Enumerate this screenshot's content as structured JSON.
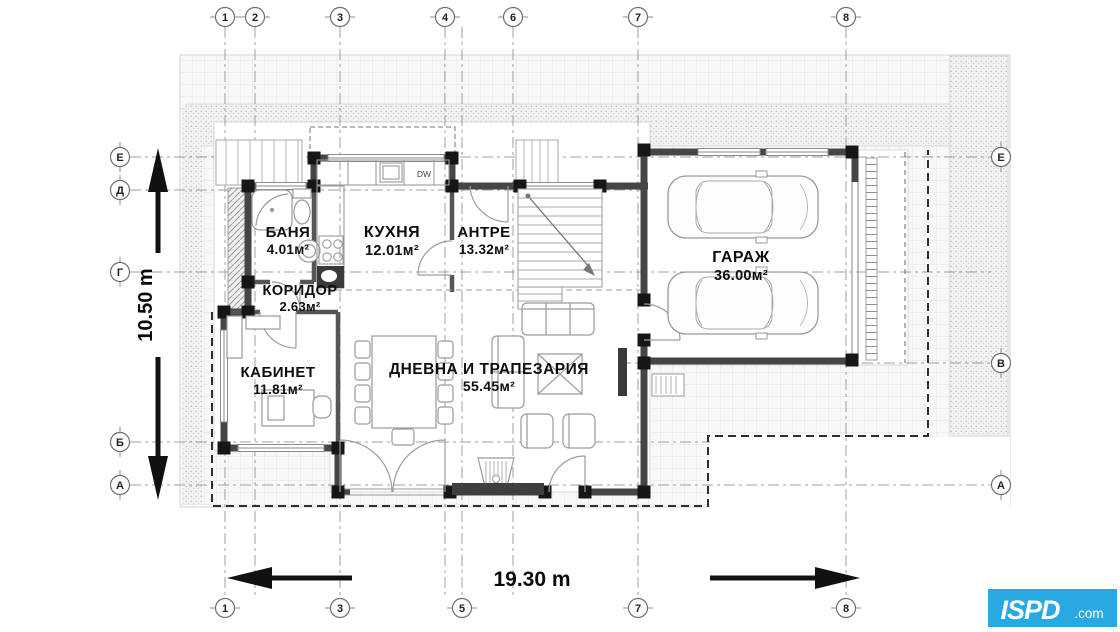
{
  "rooms": [
    {
      "name": "БАНЯ",
      "area": "4.01м²"
    },
    {
      "name": "КУХНЯ",
      "area": "12.01м²"
    },
    {
      "name": "АНТРЕ",
      "area": "13.32м²"
    },
    {
      "name": "КОРИДОР",
      "area": "2.63м²"
    },
    {
      "name": "КАБИНЕТ",
      "area": "11.81м²"
    },
    {
      "name": "ДНЕВНА И ТРАПЕЗАРИЯ",
      "area": "55.45м²"
    },
    {
      "name": "ГАРАЖ",
      "area": "36.00м²"
    }
  ],
  "appliances": {
    "dishwasher_label": "DW"
  },
  "dimensions": {
    "total_width": "19.30 m",
    "total_height": "10.50 m"
  },
  "grid": {
    "top": [
      "1",
      "2",
      "3",
      "4",
      "6",
      "7",
      "8"
    ],
    "bottom": [
      "1",
      "3",
      "5",
      "7",
      "8"
    ],
    "left": [
      "Е",
      "Д",
      "Г",
      "Б",
      "А"
    ],
    "right": [
      "Е",
      "В",
      "А"
    ]
  },
  "logo": {
    "brand": "ISPD",
    "suffix": ".com",
    "bg_color": "#29a9e1"
  }
}
